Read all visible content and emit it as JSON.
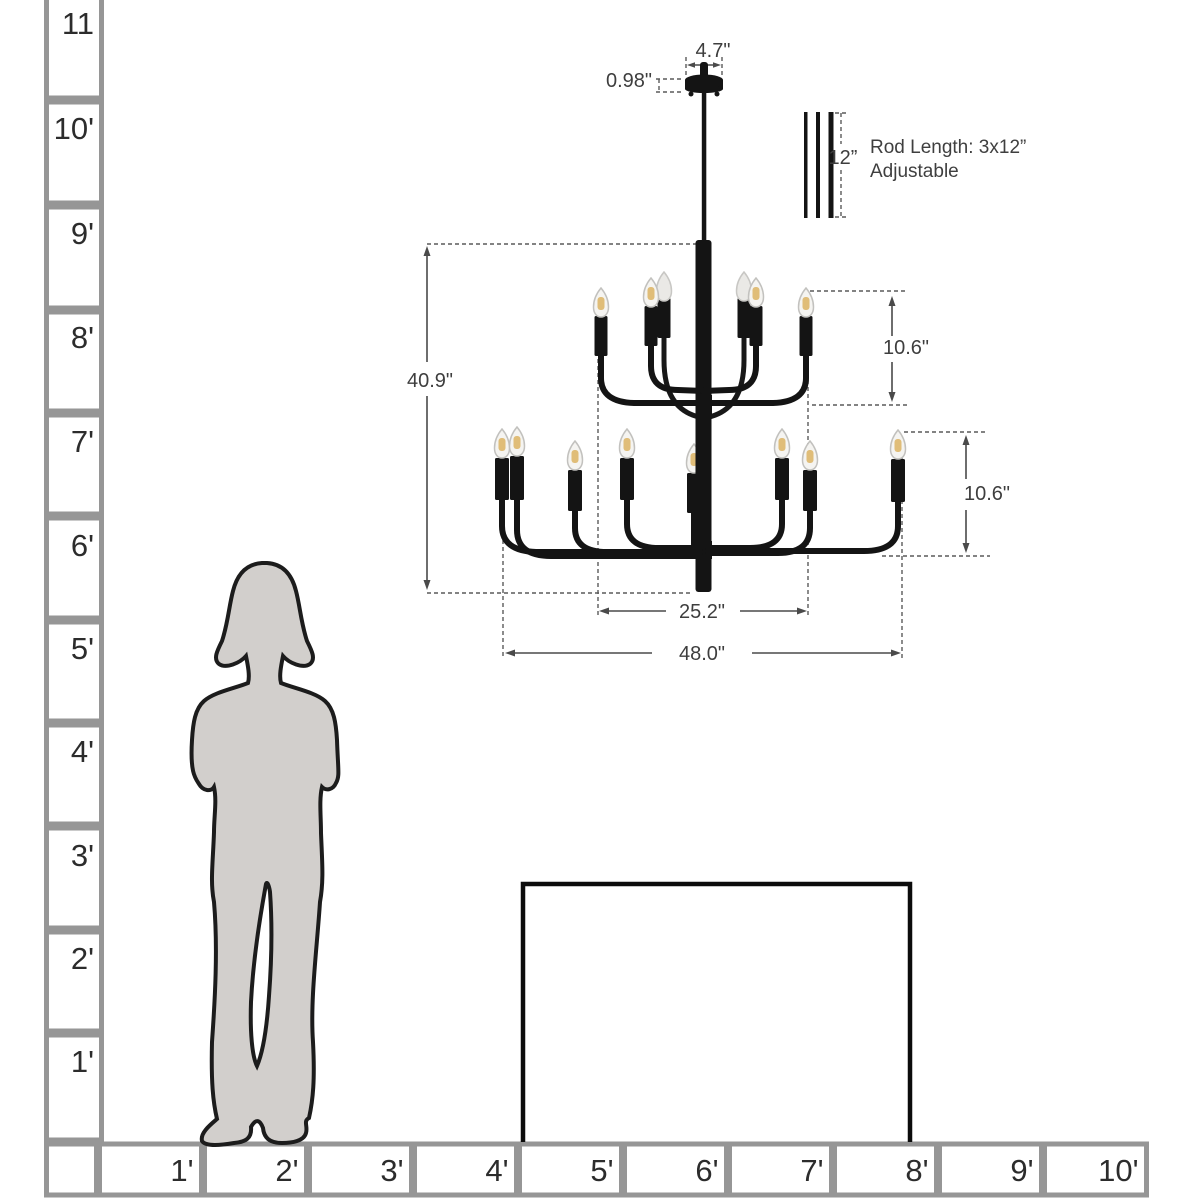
{
  "colors": {
    "chandelier_black": "#141414",
    "ruler_gray": "#969696",
    "silhouette_fill": "#d2cfcc",
    "dimension_gray": "#4a4a4a",
    "bulb_filament": "#e0bd78",
    "table_black": "#0c0c0c"
  },
  "left_ruler": {
    "labels": [
      "11",
      "10'",
      "9'",
      "8'",
      "7'",
      "6'",
      "5'",
      "4'",
      "3'",
      "2'",
      "1'"
    ]
  },
  "bottom_ruler": {
    "labels": [
      "1'",
      "2'",
      "3'",
      "4'",
      "5'",
      "6'",
      "7'",
      "8'",
      "9'",
      "10'"
    ]
  },
  "annotations": {
    "canopy_width": "4.7\"",
    "canopy_height": "0.98\"",
    "rod_segment_length": "12”",
    "rod_note_line1": "Rod Length: 3x12”",
    "rod_note_line2": "Adjustable",
    "fixture_height": "40.9\"",
    "upper_tier_height": "10.6\"",
    "lower_tier_height": "10.6\"",
    "upper_tier_width": "25.2\"",
    "lower_tier_width": "48.0\""
  }
}
